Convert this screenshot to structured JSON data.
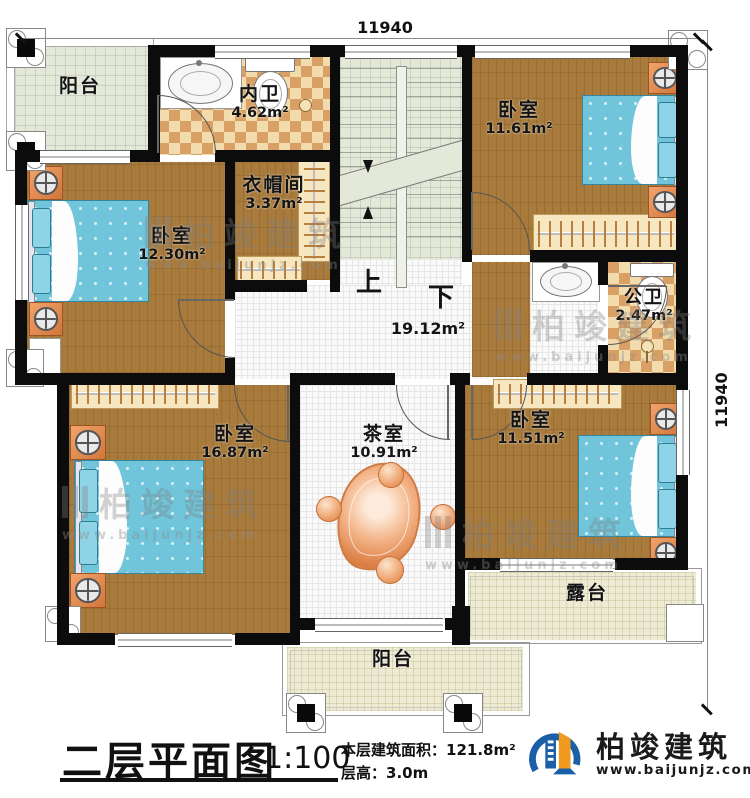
{
  "dimensions": {
    "top": "11940",
    "right": "11940"
  },
  "rooms": {
    "balcony_top": {
      "name": "阳台"
    },
    "inner_bath": {
      "name": "内卫",
      "area": "4.62m²"
    },
    "bedroom_top_right": {
      "name": "卧室",
      "area": "11.61m²"
    },
    "cloakroom": {
      "name": "衣帽间",
      "area": "3.37m²"
    },
    "bedroom_left": {
      "name": "卧室",
      "area": "12.30m²"
    },
    "hall": {
      "area": "19.12m²"
    },
    "public_bath": {
      "name": "公卫",
      "area": "2.47m²"
    },
    "bedroom_bottom_left": {
      "name": "卧室",
      "area": "16.87m²"
    },
    "tea_room": {
      "name": "茶室",
      "area": "10.91m²"
    },
    "bedroom_bottom_right": {
      "name": "卧室",
      "area": "11.51m²"
    },
    "terrace": {
      "name": "露台"
    },
    "balcony_bottom": {
      "name": "阳台"
    }
  },
  "stairs": {
    "up_label": "上",
    "down_label": "下"
  },
  "title_block": {
    "title": "二层平面图",
    "scale": "1:100",
    "area_label": "本层建筑面积：",
    "area_value": "121.8m²",
    "height_label": "层高：",
    "height_value": "3.0m"
  },
  "brand": {
    "name": "柏竣建筑",
    "url": "www.baijunjz.com"
  },
  "watermark": {
    "name": "柏竣建筑",
    "url": "www.baijunjz.com"
  }
}
